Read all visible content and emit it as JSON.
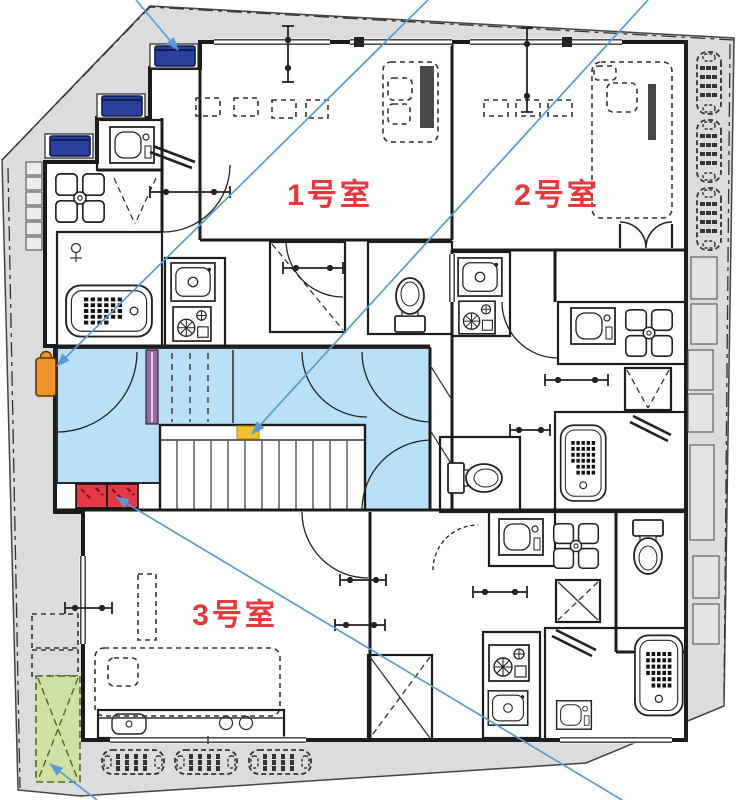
{
  "meta": {
    "type": "architectural-floor-plan",
    "floor": "apartment plan with shared stair core"
  },
  "palette": {
    "site_gray": "#dcdcdc",
    "wall_black": "#1c1c1c",
    "corridor_blue": "#b9e0f6",
    "label_red": "#e8373d",
    "leader_blue": "#5b9bd5",
    "heater_navy": "#2b3f9e",
    "heater_orange": "#f0932a",
    "stair_marker_yellow": "#f2c12e",
    "entrance_box_red": "#e63946",
    "door_purple": "#9a6aa8",
    "planting_green": "#cfe0a5"
  },
  "rooms": [
    {
      "id": "1",
      "label": "1号室"
    },
    {
      "id": "2",
      "label": "2号室"
    },
    {
      "id": "3",
      "label": "3号室"
    }
  ]
}
